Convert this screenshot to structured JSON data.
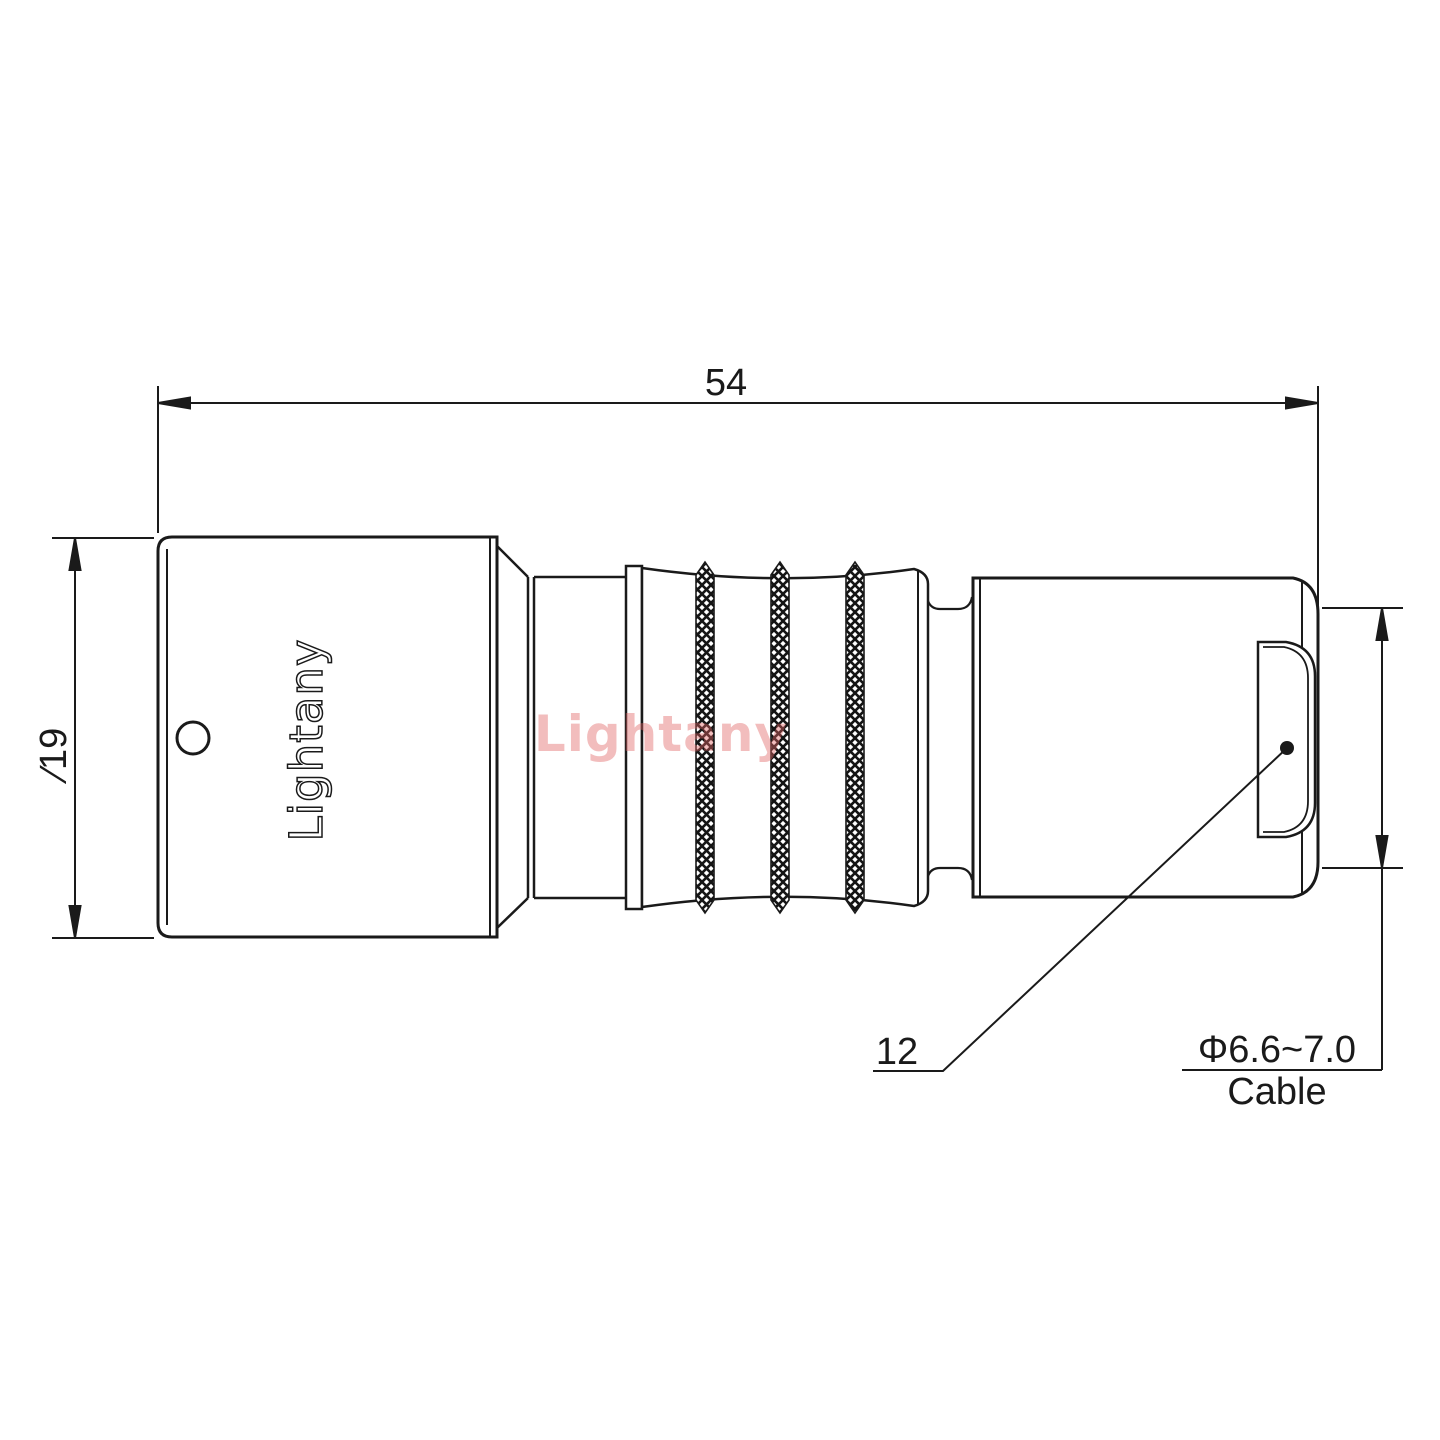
{
  "drawing": {
    "type": "connector technical drawing, side view",
    "watermark": {
      "text": "Lightany",
      "color": "#e16464"
    },
    "part": {
      "body_logo": "Lightany"
    },
    "dimensions": {
      "overall_length": "54",
      "body_diameter": "∕19",
      "boot_reference": "12",
      "cable_diameter_range": "Φ6.6~7.0",
      "cable_label": "Cable"
    },
    "colors": {
      "line": "#1a1a1a",
      "background": "#ffffff"
    }
  }
}
